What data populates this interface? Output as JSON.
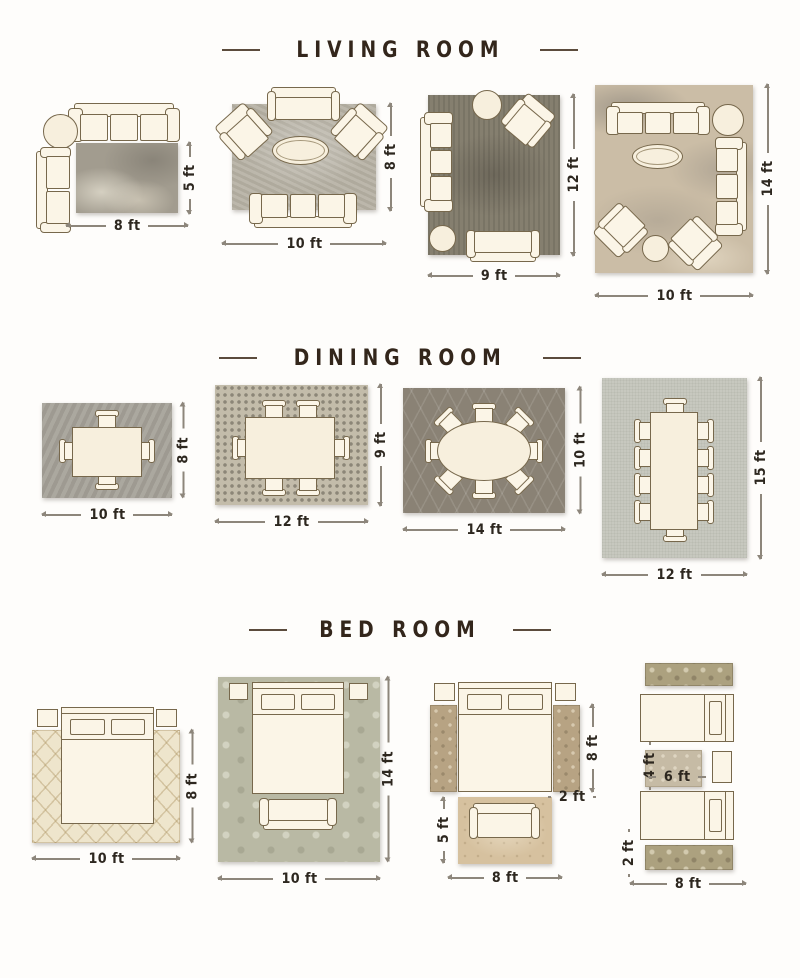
{
  "sections": {
    "living": {
      "title": "LIVING ROOM",
      "layouts": [
        {
          "width_label": "8 ft",
          "height_label": "5 ft"
        },
        {
          "width_label": "10 ft",
          "height_label": "8 ft"
        },
        {
          "width_label": "9 ft",
          "height_label": "12 ft"
        },
        {
          "width_label": "10 ft",
          "height_label": "14 ft"
        }
      ]
    },
    "dining": {
      "title": "DINING ROOM",
      "layouts": [
        {
          "width_label": "10 ft",
          "height_label": "8 ft"
        },
        {
          "width_label": "12 ft",
          "height_label": "9 ft"
        },
        {
          "width_label": "14 ft",
          "height_label": "10 ft"
        },
        {
          "width_label": "12 ft",
          "height_label": "15 ft"
        }
      ]
    },
    "bedroom": {
      "title": "BED ROOM",
      "layouts": [
        {
          "width_label": "10 ft",
          "height_label": "8 ft"
        },
        {
          "width_label": "10 ft",
          "height_label": "14 ft"
        },
        {
          "bottom_width_label": "8 ft",
          "bottom_height_label": "5 ft",
          "runner_length_label": "8 ft",
          "runner_width_label": "2 ft"
        },
        {
          "bottom_width_label": "8 ft",
          "runner_width_label": "2 ft",
          "center_rug_width_label": "6 ft",
          "center_rug_height_label": "4 ft"
        }
      ]
    }
  },
  "colors": {
    "title_text": "#33261b",
    "dimension_text": "#2d271f",
    "furniture_fill": "#fbf5e7",
    "furniture_outline": "#77684c"
  }
}
